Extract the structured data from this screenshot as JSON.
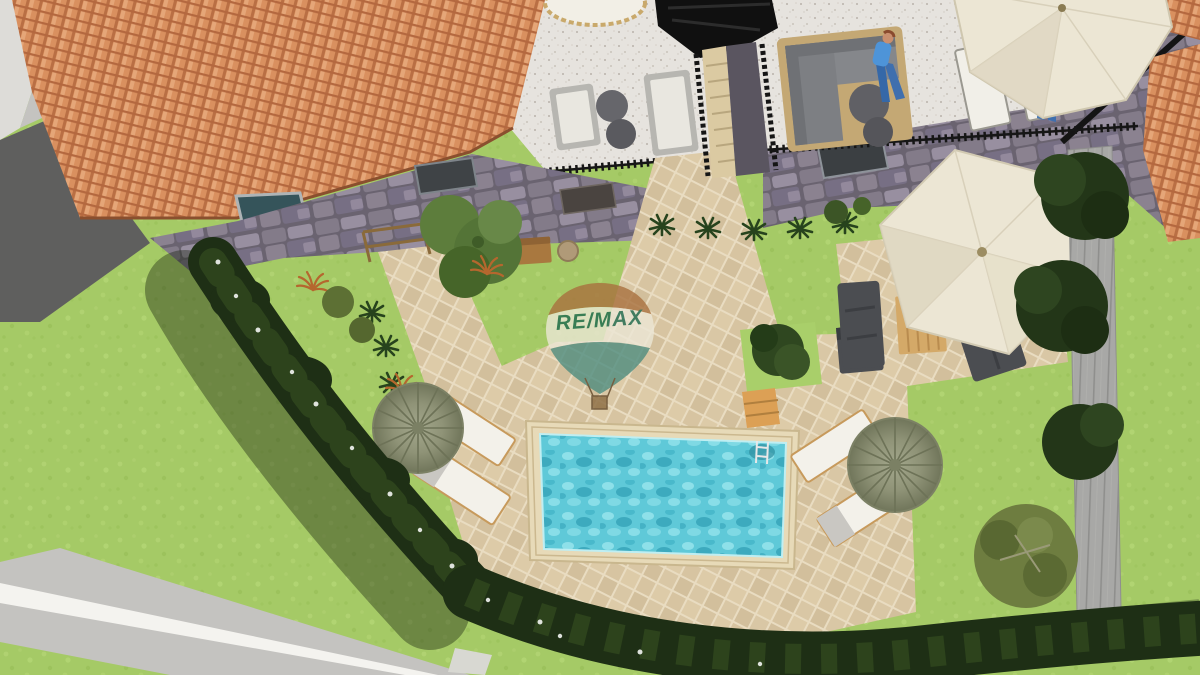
{
  "watermark": {
    "brand": "RE/MAX",
    "balloon_top_color": "#a9713f",
    "balloon_band_color": "#ece7d6",
    "balloon_bottom_color": "#4f8d7f",
    "text_color": "#1d6b50",
    "basket_color": "#8a6a40"
  },
  "scene": {
    "description": "3D aerial rendering of a villa garden: terracotta-roof house with stone facade, upper terrace with outdoor furniture, landscaped garden, paver patio with rectangular swimming pool, sun loungers with thatch parasols, cream umbrellas, dark hedge border, lawn and side road",
    "elements": [
      "house-roof",
      "stone-facade",
      "upper-terrace",
      "swimming-pool",
      "paver-patio",
      "hedge",
      "lawn",
      "road",
      "sun-loungers",
      "thatch-parasols",
      "cream-umbrellas",
      "garden-sofas",
      "wooden-table",
      "boardwalk-deck",
      "olive-tree",
      "remax-balloon-watermark"
    ]
  },
  "colors": {
    "grass": "#a5ca66",
    "grass_light": "#b6d677",
    "grass_patch": "#a9cf6a",
    "roof_tile": "#d9905f",
    "roof_tile_dark": "#b96f44",
    "roof_tile_light": "#e8ab7d",
    "stone": "#837b89",
    "stone_light": "#988fa0",
    "stone_dark": "#6a6370",
    "paver": "#d9c7a5",
    "paver_joint": "#e9dcc1",
    "terrace": "#e6e3de",
    "terrace_speckle": "#b9b3ab",
    "pool_water": "#5fc9d8",
    "pool_water_light": "#94e3ec",
    "pool_water_dark": "#35a3b8",
    "pool_coping": "#e7dab8",
    "hedge": "#1e2f15",
    "hedge_highlight": "#2d431c",
    "road_light": "#dddcd8",
    "road_mid": "#c4c3c0",
    "road_dark": "#5f5f5e",
    "road_stripe": "#f4f3ef",
    "deck": "#a8a8a6",
    "deck_line": "#8f8f8d",
    "umbrella_cream": "#ece6d4",
    "umbrella_shade": "#ded6c0",
    "parasol": "#8f9377",
    "parasol_dark": "#6d7257",
    "sofa_dark": "#4b4d51",
    "sofa_light_frame": "#b7b6b1",
    "sofa_light_cushion": "#e9e7e0",
    "rattan": "#c4a874",
    "wood": "#d4a968",
    "wood_dark": "#b07f3e",
    "railing": "#161616",
    "tree_dark": "#233618",
    "tree_olive": "#6e7d40",
    "tree_green": "#547437",
    "person_skin": "#c98f6f",
    "person_jeans": "#3f6fae",
    "person_shirt": "#4e94d8"
  }
}
